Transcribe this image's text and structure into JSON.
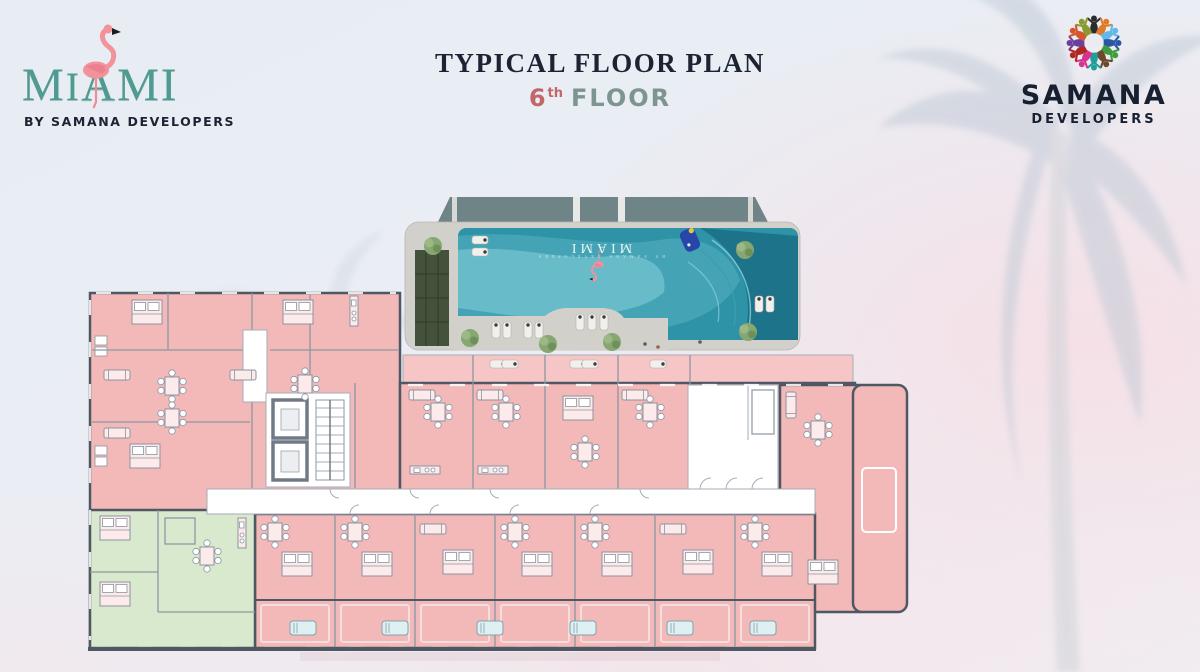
{
  "header": {
    "title": "TYPICAL FLOOR PLAN",
    "floor_number": "6",
    "floor_ordinal": "th",
    "floor_word": "FLOOR"
  },
  "brand": {
    "name_first": "M",
    "name_second": "I",
    "name_rest": "AMI",
    "full_name": "MIAMI",
    "tagline": "BY SAMANA DEVELOPERS"
  },
  "developer": {
    "name": "SAMANA",
    "subtitle": "DEVELOPERS"
  },
  "pool_render": {
    "brand_text": "MIAMI",
    "sub_text": "BY SAMANA DEVELOPERS"
  },
  "floor_plan": {
    "unit_color_standard": "#f3b8b8",
    "unit_color_balcony": "#f6c5c5",
    "unit_color_alternate": "#d8e9cd",
    "wall_color": "#4e5863",
    "corridor_color": "#ffffff"
  },
  "colors": {
    "miami_teal": "#4f9b91",
    "flamingo_pink": "#f2929b",
    "accent_red": "#c2666a",
    "accent_teal": "#7e958f",
    "title_dark": "#1c2333",
    "pool_water": "#2f93a7"
  },
  "icons": [
    "flamingo-icon",
    "samana-emblem-icon",
    "palm-watermark-right-icon",
    "palm-watermark-left-icon"
  ]
}
